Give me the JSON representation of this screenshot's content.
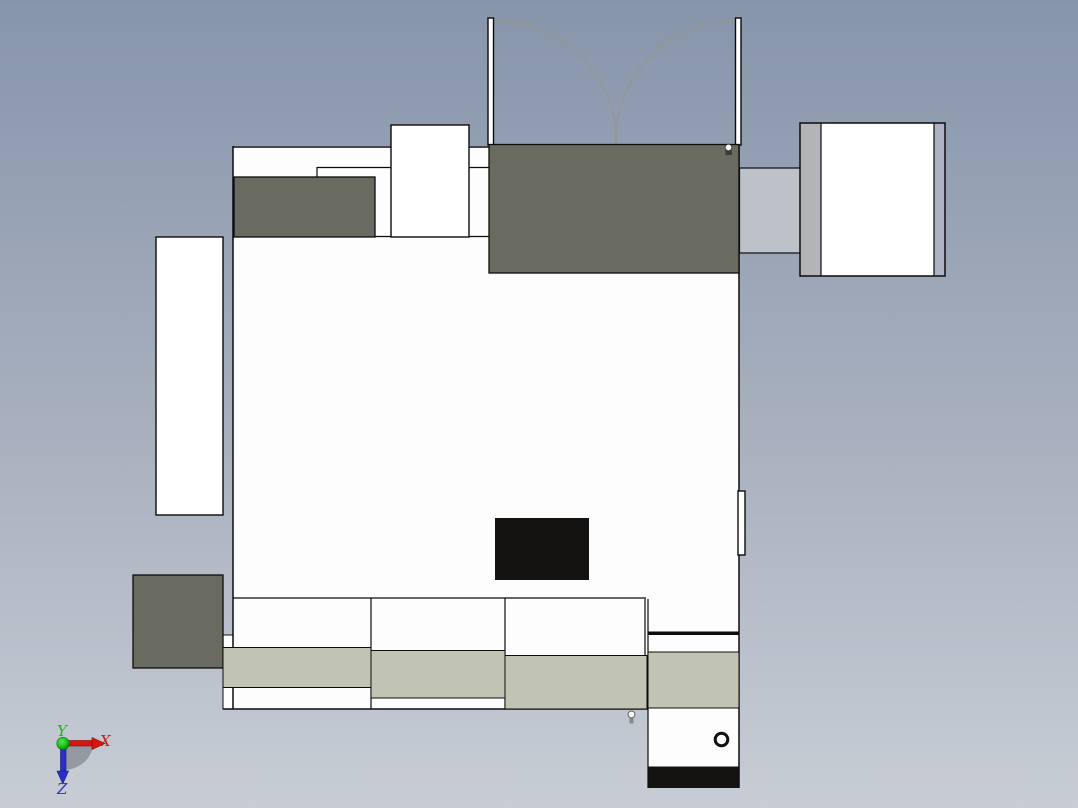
{
  "viewport": {
    "width": 1078,
    "height": 808,
    "kind": "3d-cad-model-top-view"
  },
  "axis_triad": {
    "x_label": "X",
    "y_label": "Y",
    "z_label": "Z",
    "x_color": "#d8150e",
    "y_color": "#12bb12",
    "z_color": "#2a2fc8"
  },
  "palette": {
    "background_top": "#8795ab",
    "background_bottom": "#c8cdd5",
    "model_white": "#fdfdfd",
    "panel_olive": "#696b60",
    "counter_beige": "#c2c4b3",
    "connector_gray": "#bdc1c8",
    "cabinet_strip_gray": "#b2b4b7",
    "cabinet_strip_blue": "#aeb2c5",
    "display_black": "#141312",
    "outline": "#0c0c0c",
    "door_arc": "#95968e"
  },
  "icons": {
    "door_knob": "sphere-marker",
    "floor_pin": "sphere-marker",
    "pipe_ring": "ring-marker"
  }
}
